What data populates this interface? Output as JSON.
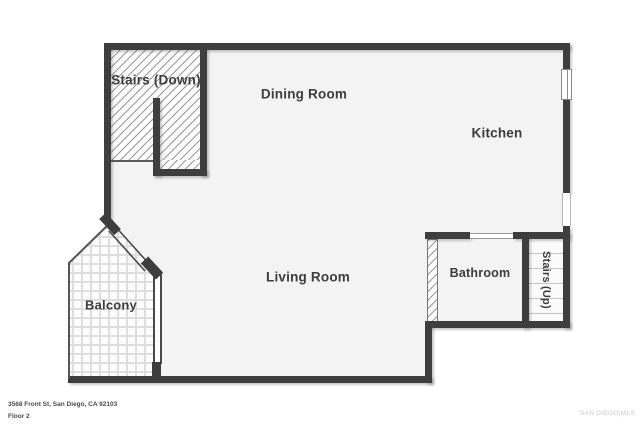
{
  "title": "Floor plan - Floor 2",
  "rooms": {
    "stairs_down": {
      "label": "Stairs (Down)"
    },
    "dining": {
      "label": "Dining Room"
    },
    "kitchen": {
      "label": "Kitchen"
    },
    "living": {
      "label": "Living Room"
    },
    "balcony": {
      "label": "Balcony"
    },
    "bathroom": {
      "label": "Bathroom"
    },
    "stairs_up": {
      "label": "Stairs (Up)"
    }
  },
  "footer": {
    "address": "3568 Front St, San Diego, CA 92103",
    "floor": "Floor 2"
  },
  "watermark": "SAN DIEGO|MLS",
  "colors": {
    "wall": "#3e3e3e",
    "floor": "#f3f3f3",
    "hatch_line": "#9a9a9a",
    "tile_line": "#dedede",
    "tread_line": "#c5c5c5",
    "label_text": "#3d3d3d",
    "footer_text": "#4a4a4a",
    "watermark_text": "#c8c8c8"
  }
}
